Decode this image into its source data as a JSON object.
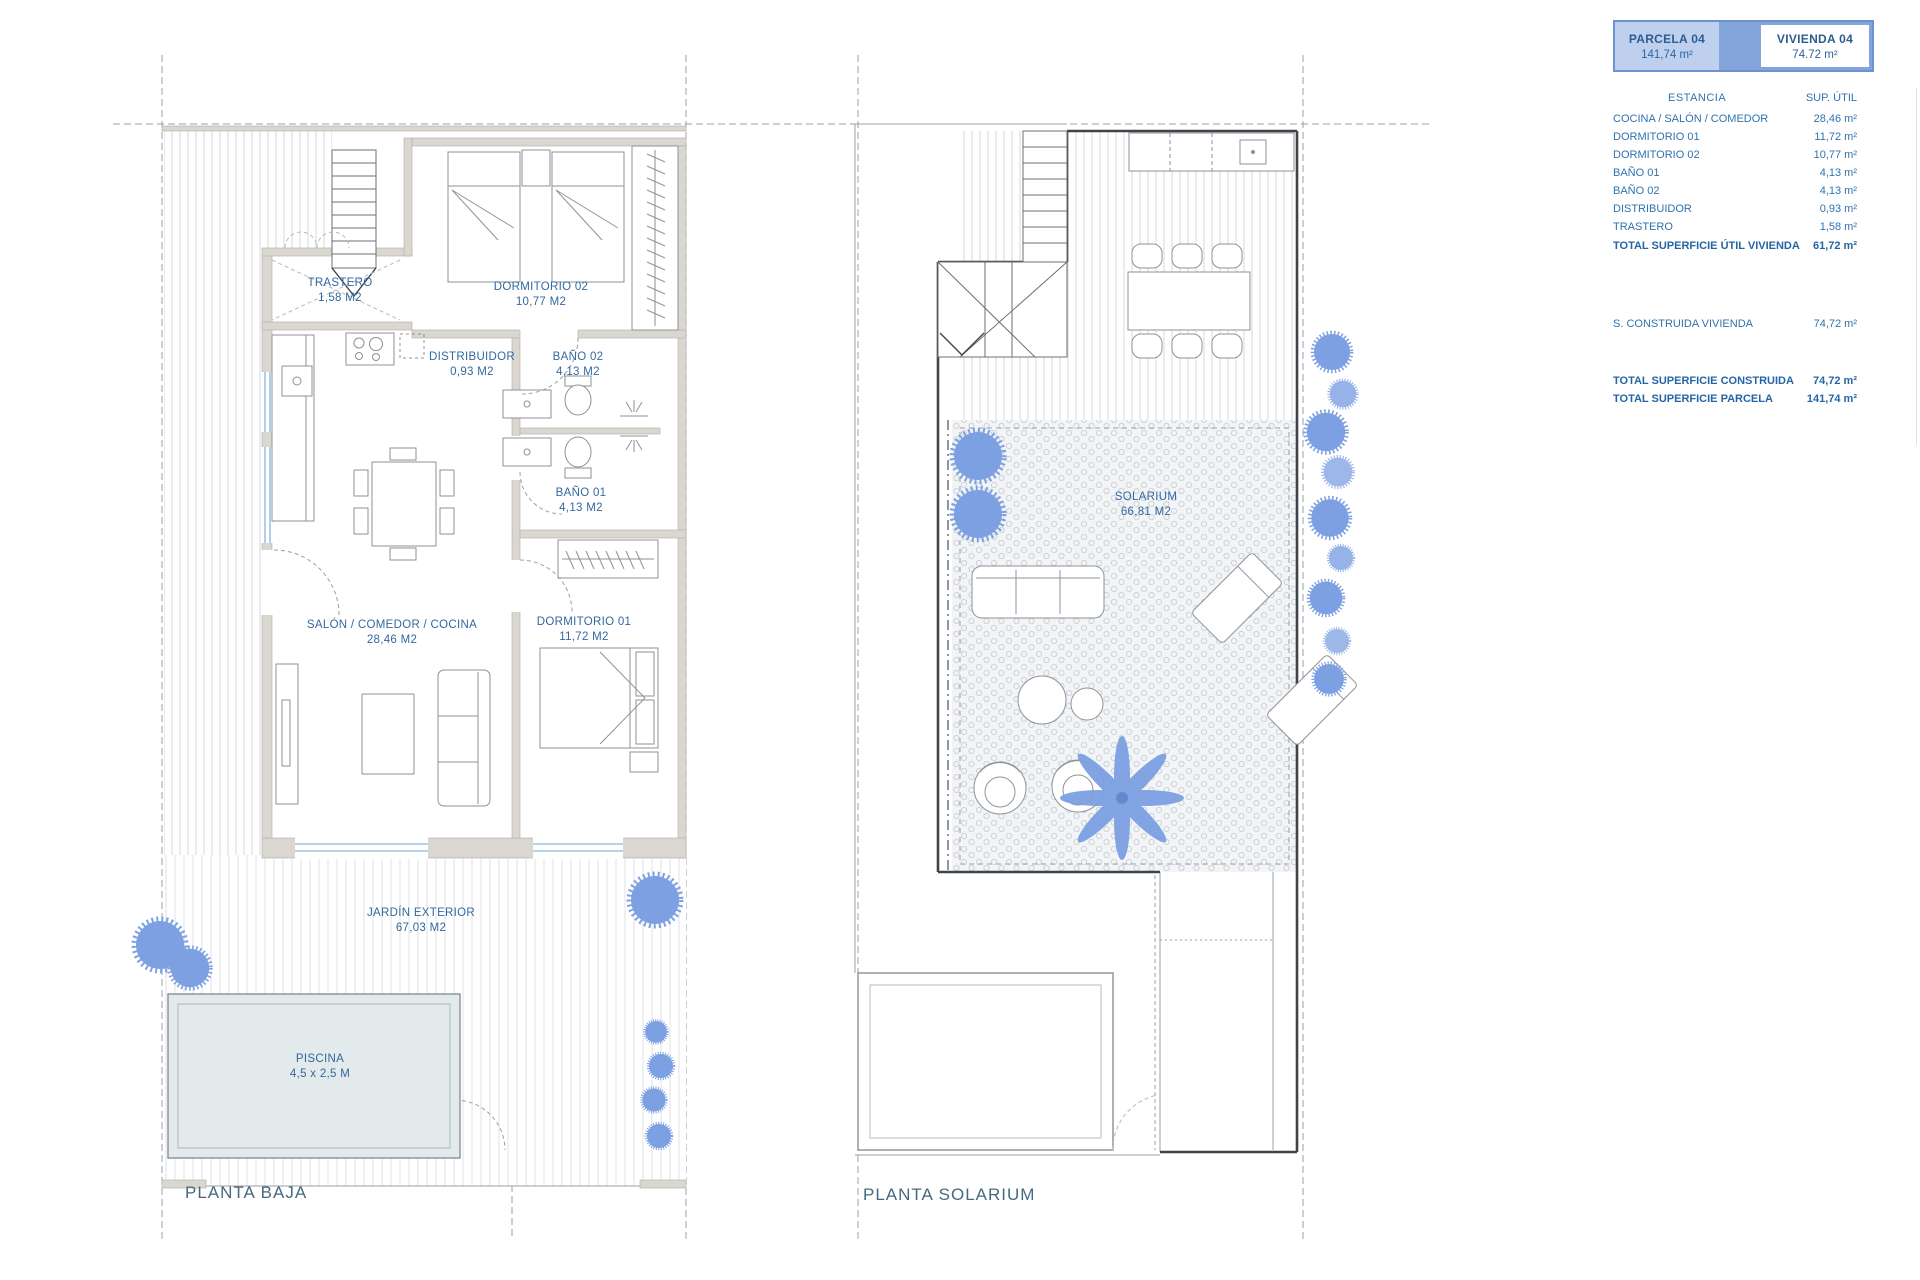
{
  "legend": {
    "parcela": {
      "title": "PARCELA 04",
      "value": "141,74 m²"
    },
    "vivienda": {
      "title": "VIVIENDA 04",
      "value": "74.72 m²"
    },
    "header": {
      "estancia": "ESTANCIA",
      "sup_util": "SUP.  ÚTIL"
    },
    "rows": [
      {
        "label": "COCINA / SALÓN / COMEDOR",
        "value": "28,46 m²"
      },
      {
        "label": "DORMITORIO 01",
        "value": "11,72 m²"
      },
      {
        "label": "DORMITORIO 02",
        "value": "10,77 m²"
      },
      {
        "label": "BAÑO 01",
        "value": "4,13 m²"
      },
      {
        "label": "BAÑO 02",
        "value": "4,13 m²"
      },
      {
        "label": "DISTRIBUIDOR",
        "value": "0,93 m²"
      },
      {
        "label": "TRASTERO",
        "value": "1,58 m²"
      }
    ],
    "total_util": {
      "label": "TOTAL SUPERFICIE ÚTIL VIVIENDA",
      "value": "61,72 m²"
    },
    "construida": {
      "label": "S. CONSTRUIDA VIVIENDA",
      "value": "74,72 m²"
    },
    "total_construida": {
      "label": "TOTAL SUPERFICIE CONSTRUIDA",
      "value": "74,72 m²"
    },
    "total_parcela": {
      "label": "TOTAL SUPERFICIE PARCELA",
      "value": "141,74 m²"
    }
  },
  "plans": {
    "baja": {
      "title": "PLANTA BAJA",
      "rooms": {
        "trastero": {
          "name": "TRASTERO",
          "area": "1,58 M2"
        },
        "dormitorio02": {
          "name": "DORMITORIO 02",
          "area": "10,77 M2"
        },
        "distribuidor": {
          "name": "DISTRIBUIDOR",
          "area": "0,93 M2"
        },
        "bano02": {
          "name": "BAÑO 02",
          "area": "4,13 M2"
        },
        "bano01": {
          "name": "BAÑO 01",
          "area": "4,13 M2"
        },
        "dormitorio01": {
          "name": "DORMITORIO 01",
          "area": "11,72 M2"
        },
        "salon": {
          "name": "SALÓN / COMEDOR / COCINA",
          "area": "28,46 M2"
        },
        "jardin": {
          "name": "JARDÍN EXTERIOR",
          "area": "67,03 M2"
        },
        "piscina": {
          "name": "PISCINA",
          "area": "4,5 x 2,5 M"
        }
      }
    },
    "solarium": {
      "title": "PLANTA SOLARIUM",
      "rooms": {
        "solarium": {
          "name": "SOLARIUM",
          "area": "66,81 M2"
        }
      }
    }
  },
  "colors": {
    "accent_blue": "#6e92cf",
    "header_cell_bg": "#bed0ee",
    "header_gap_bg": "#84a5dc",
    "text_blue": "#2f72ae",
    "room_label_blue": "#33689f",
    "plan_title": "#46697f",
    "wall_fill": "#d9d7cf",
    "plant_blue": "#7da0e2",
    "window_blue": "#9dc3e6",
    "pool_fill": "#e2eaec"
  }
}
